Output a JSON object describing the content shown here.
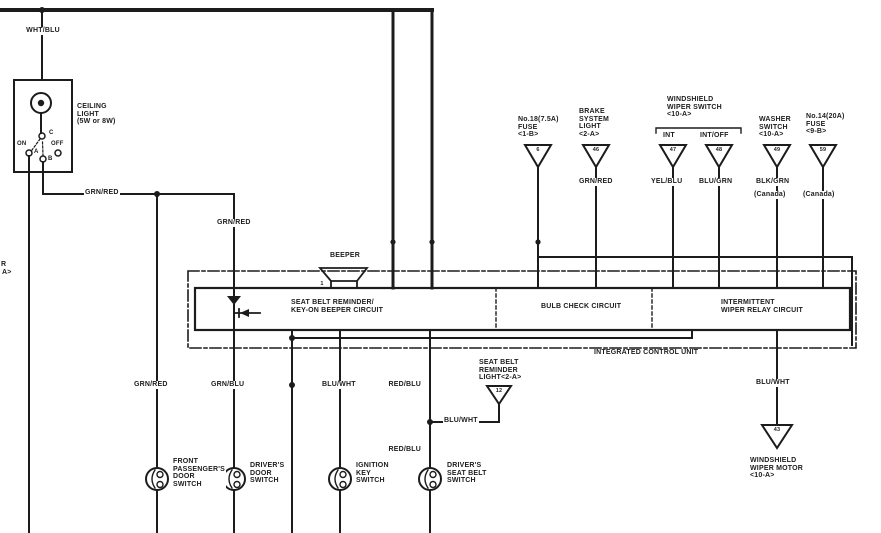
{
  "colors": {
    "background": "#ffffff",
    "line": "#1c1c1c"
  },
  "diagram": {
    "power": {
      "wire_in": "WHT/BLU"
    },
    "ceiling_light": {
      "label": "CEILING\nLIGHT\n(5W or 8W)",
      "positions": {
        "on": "ON",
        "off": "OFF",
        "a": "A",
        "b": "B",
        "c": "C"
      },
      "wire_out": "GRN/RED"
    },
    "wires": {
      "grn_red_drop": "GRN/RED",
      "grn_red_bottom": "GRN/RED",
      "grn_blu_bottom": "GRN/BLU",
      "blu_wht_bottom": "BLU/WHT",
      "red_blu_upper": "RED/BLU",
      "red_blu_lower": "RED/BLU",
      "blu_wht_branch": "BLU/WHT",
      "blu_wht_motor": "BLU/WHT"
    },
    "beeper": {
      "label": "BEEPER",
      "pin": "1"
    },
    "icu": {
      "label": "INTEGRATED CONTROL UNIT",
      "sections": [
        {
          "label": "SEAT BELT REMINDER/\nKEY-ON BEEPER CIRCUIT"
        },
        {
          "label": "BULB CHECK CIRCUIT"
        },
        {
          "label": "INTERMITTENT\nWIPER RELAY CIRCUIT"
        }
      ]
    },
    "wiper_switch_group": {
      "label": "WINDSHIELD\nWIPER SWITCH\n<10-A>"
    },
    "top_connectors": [
      {
        "label": "No.18(7.5A)\nFUSE\n<1-B>",
        "pin": "6",
        "wire": ""
      },
      {
        "label": "BRAKE\nSYSTEM\nLIGHT\n<2-A>",
        "pin": "46",
        "wire": "GRN/RED"
      },
      {
        "label": "INT",
        "pin": "47",
        "wire": "YEL/BLU"
      },
      {
        "label": "INT/OFF",
        "pin": "48",
        "wire": "BLU/GRN"
      },
      {
        "label": "WASHER\nSWITCH\n<10-A>",
        "pin": "49",
        "wire": "BLK/GRN",
        "note": "(Canada)"
      },
      {
        "label": "No.14(20A)\nFUSE\n<9-B>",
        "pin": "59",
        "wire": "",
        "note": "(Canada)"
      }
    ],
    "bottom_components": {
      "front_passenger_door_switch": {
        "label": "FRONT\nPASSENGER'S\nDOOR\nSWITCH"
      },
      "driver_door_switch": {
        "label": "DRIVER'S\nDOOR\nSWITCH"
      },
      "ignition_key_switch": {
        "label": "IGNITION\nKEY\nSWITCH"
      },
      "driver_seat_belt_switch": {
        "label": "DRIVER'S\nSEAT BELT\nSWITCH"
      },
      "seat_belt_reminder_light": {
        "label": "SEAT BELT\nREMINDER\nLIGHT<2-A>",
        "pin": "12"
      },
      "windshield_wiper_motor": {
        "label": "WINDSHIELD\nWIPER MOTOR\n<10-A>",
        "pin": "43"
      }
    },
    "edge_fragments": {
      "line1": "R",
      "line2": "A>"
    }
  }
}
